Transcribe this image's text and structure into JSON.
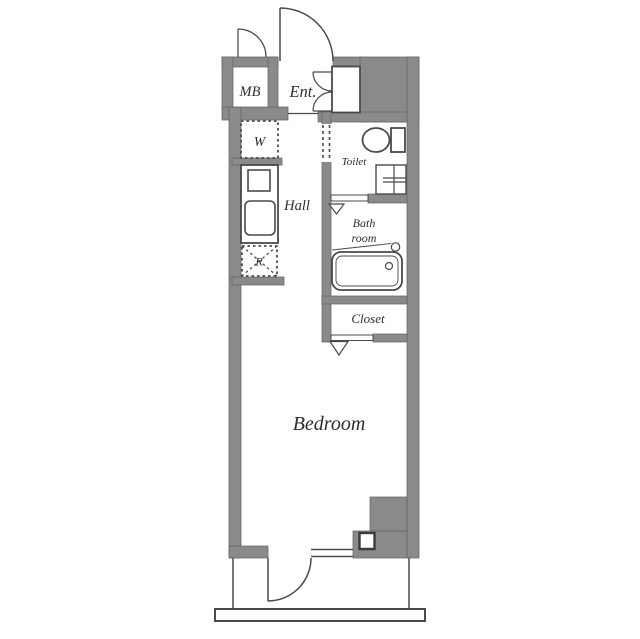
{
  "plan": {
    "title": "studio-apartment-floor-plan",
    "rooms": {
      "mb": {
        "label": "MB"
      },
      "entrance": {
        "label": "Ent."
      },
      "washer": {
        "label": "W"
      },
      "hall": {
        "label": "Hall"
      },
      "toilet": {
        "label": "Toilet"
      },
      "bathroom": {
        "line1": "Bath",
        "line2": "room"
      },
      "closet": {
        "label": "Closet"
      },
      "refrigerator": {
        "label": "R"
      },
      "bedroom": {
        "label": "Bedroom"
      }
    },
    "fixtures": [
      "entrance-door",
      "mb-door",
      "shoe-cabinet-doors",
      "shoe-storage",
      "washer-space",
      "kitchen-unit",
      "refrigerator-space",
      "toilet-fixture",
      "vanity-sink",
      "bathtub",
      "bath-folding-door",
      "closet-folding-door",
      "balcony-door",
      "fixed-window",
      "pipe-shaft",
      "balcony-rail"
    ],
    "colors": {
      "wall_fill": "#8a8a8a",
      "wall_edge": "#666666",
      "line": "#4a4a4a",
      "label_text": "#2e2e2e",
      "background": "#ffffff"
    }
  }
}
